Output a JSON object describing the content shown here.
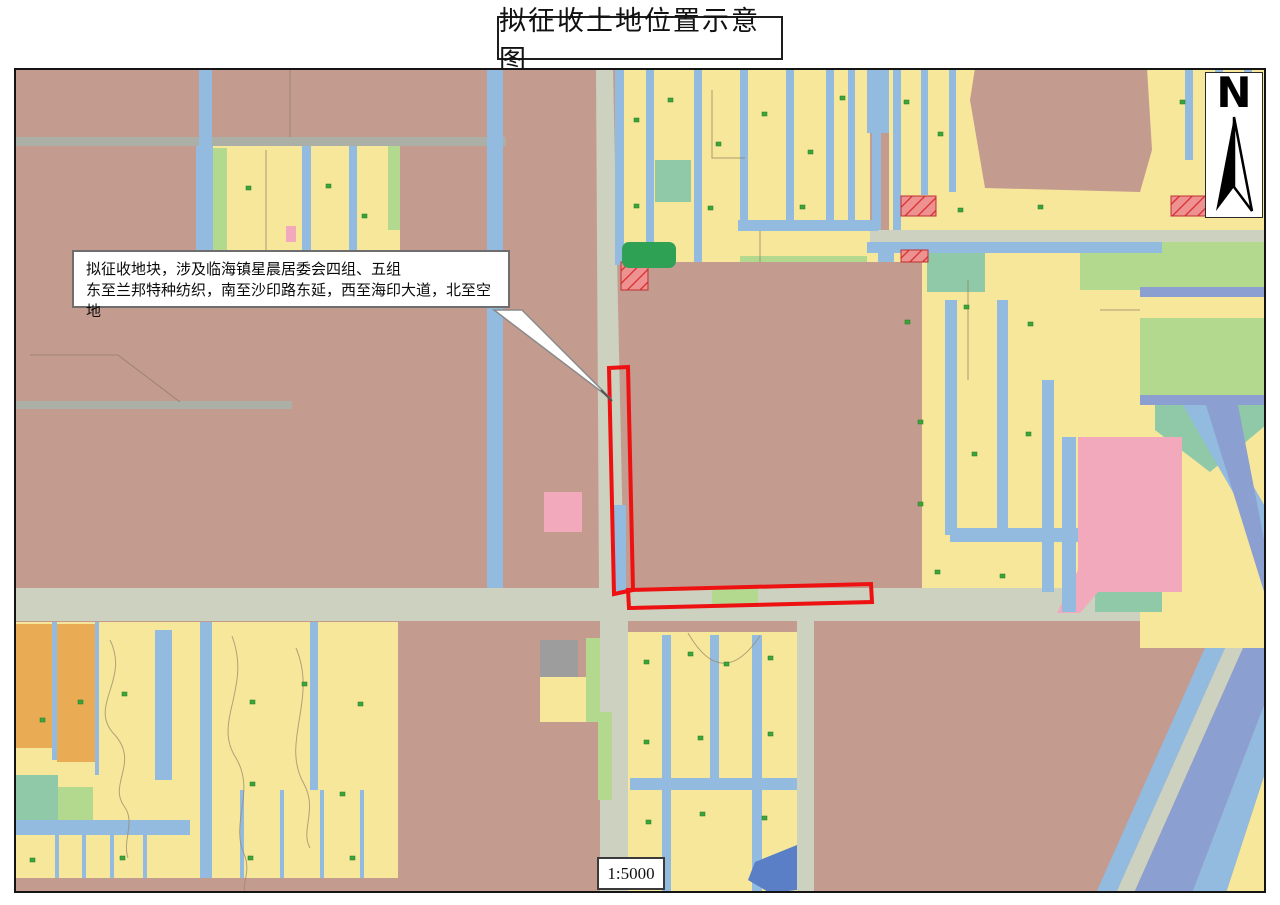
{
  "title": "拟征收土地位置示意图",
  "map": {
    "callout": {
      "line1": "拟征收地块，涉及临海镇星晨居委会四组、五组",
      "line2": "东至兰邦特种纺织，南至沙印路东延，西至海印大道，北至空地"
    },
    "north_label": "N",
    "scale_text": "1:5000"
  },
  "legend_semantics": {
    "red_outline": "拟征收地块范围",
    "hatched_red": "已建设用地",
    "yellow": "农用地",
    "blue": "河道水系",
    "brown": "建设用地"
  },
  "colors": {
    "urban_brown": "#C49B8F",
    "farmland_yellow": "#F7E79B",
    "water_blue": "#93BADF",
    "water_blue_dark": "#8B9FD0",
    "deep_blue": "#5B7FC7",
    "road_pale": "#CDD1C0",
    "road_gray": "#ABAFA5",
    "green_light": "#B3D98F",
    "green_medium": "#8FC9A8",
    "green_dark": "#2FA155",
    "pink": "#F2A9BC",
    "orange": "#E9AC55",
    "gray_parcel": "#9D9D9D",
    "dot_green": "#3DA43D",
    "hatch_red_fill": "#ED9191",
    "hatch_red_line": "#D92B2B",
    "outline_red": "#EE1111"
  }
}
